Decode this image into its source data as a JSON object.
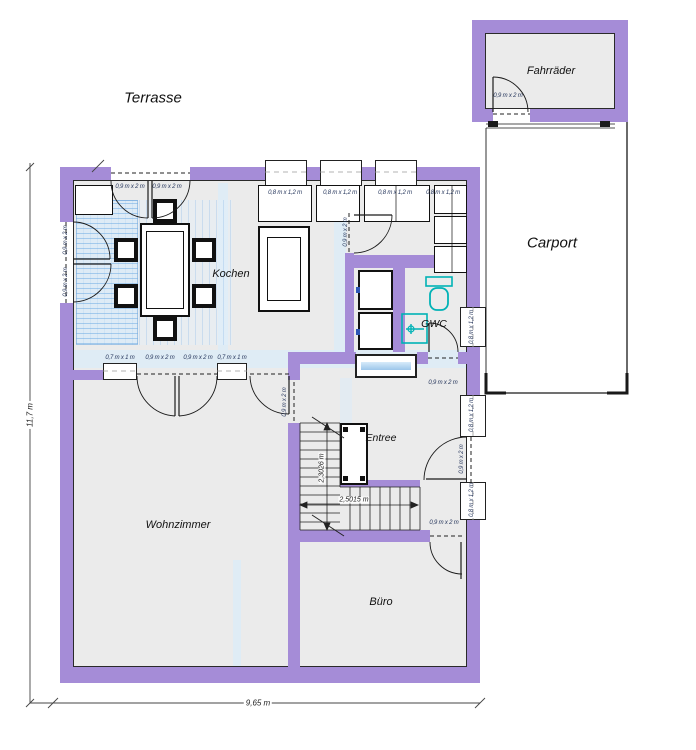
{
  "rooms": {
    "terrasse": "Terrasse",
    "fahrraeder": "Fahrräder",
    "carport": "Carport",
    "kochen": "Kochen",
    "gwc": "GWC",
    "entree": "Entree",
    "wohnzimmer": "Wohnzimmer",
    "buero": "Büro"
  },
  "dimensions": {
    "total_width": "9,65 m",
    "total_height": "11,7 m",
    "stair_run_length": "2,5015 m",
    "stair_flight_length": "2,3026 m"
  },
  "opening_sizes": {
    "door": "0,9 m x 2 m",
    "window": "0,8 m x 1,2 m",
    "small_window": "0,7 m x 1 m"
  },
  "colors": {
    "wall": "#a58cd7",
    "floor": "#ebebeb",
    "accent": "#d9ecfa",
    "carpet": "#cfe4f6",
    "fixture": "#00b2b6",
    "line": "#1a1a1a"
  }
}
